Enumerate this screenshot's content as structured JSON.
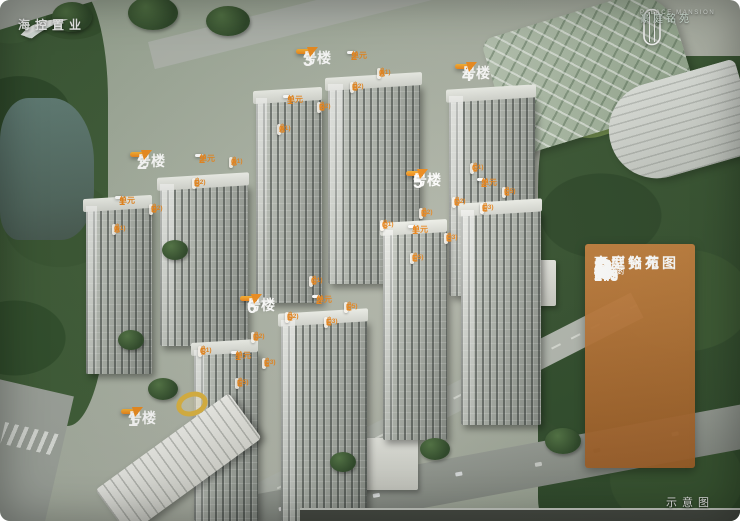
{
  "branding_left": {
    "name": "海控置业"
  },
  "branding_right": {
    "en": "PALACE MANSION",
    "cn": "豪庭铭苑"
  },
  "legend": {
    "title_line1": "豪庭铭苑",
    "title_line2": "户型分布图",
    "area_prefix": "建筑面积约",
    "unit": "m",
    "unit_sup": "2",
    "rows": [
      {
        "letter": "A",
        "value": "289"
      },
      {
        "letter": "B",
        "value": "245"
      },
      {
        "letter": "C",
        "value": "167"
      },
      {
        "letter": "D",
        "value": "163"
      },
      {
        "letter": "E",
        "value": "143"
      }
    ]
  },
  "caption": "示意图",
  "building_suffix": "号楼",
  "unit_suffix": "单元",
  "type_mid": "户型",
  "colors": {
    "label_orange": "#ef8c1d",
    "panel_brown": "#b06a2e",
    "label_text_orange": "#e8851c"
  },
  "building_labels": [
    {
      "num": "1",
      "x": 121,
      "y": 409
    },
    {
      "num": "2",
      "x": 130,
      "y": 152
    },
    {
      "num": "3",
      "x": 296,
      "y": 49
    },
    {
      "num": "4",
      "x": 455,
      "y": 64
    },
    {
      "num": "5",
      "x": 406,
      "y": 171
    },
    {
      "num": "6",
      "x": 240,
      "y": 296
    }
  ],
  "unit_labels": [
    {
      "num": "2",
      "x": 347,
      "y": 51
    },
    {
      "num": "1",
      "x": 283,
      "y": 95
    },
    {
      "num": "2",
      "x": 195,
      "y": 154
    },
    {
      "num": "1",
      "x": 115,
      "y": 196
    },
    {
      "num": "2",
      "x": 477,
      "y": 178
    },
    {
      "num": "1",
      "x": 408,
      "y": 225
    },
    {
      "num": "2",
      "x": 312,
      "y": 295
    },
    {
      "num": "1",
      "x": 231,
      "y": 351
    }
  ],
  "type_labels": [
    {
      "letter": "A",
      "num": "(01)",
      "x": 377,
      "y": 68
    },
    {
      "letter": "B",
      "num": "(02)",
      "x": 350,
      "y": 82
    },
    {
      "letter": "B",
      "num": "(02)",
      "x": 317,
      "y": 102
    },
    {
      "letter": "A",
      "num": "(01)",
      "x": 277,
      "y": 124
    },
    {
      "letter": "A",
      "num": "(01)",
      "x": 229,
      "y": 157
    },
    {
      "letter": "B",
      "num": "(02)",
      "x": 192,
      "y": 178
    },
    {
      "letter": "B",
      "num": "(02)",
      "x": 149,
      "y": 204
    },
    {
      "letter": "A",
      "num": "(01)",
      "x": 112,
      "y": 224
    },
    {
      "letter": "C",
      "num": "(01)",
      "x": 470,
      "y": 163
    },
    {
      "letter": "E",
      "num": "(05)",
      "x": 502,
      "y": 187
    },
    {
      "letter": "D",
      "num": "(02)",
      "x": 452,
      "y": 197
    },
    {
      "letter": "E",
      "num": "(03)",
      "x": 480,
      "y": 203
    },
    {
      "letter": "D",
      "num": "(02)",
      "x": 419,
      "y": 208
    },
    {
      "letter": "C",
      "num": "(01)",
      "x": 380,
      "y": 220
    },
    {
      "letter": "E",
      "num": "(03)",
      "x": 444,
      "y": 233
    },
    {
      "letter": "E",
      "num": "(05)",
      "x": 410,
      "y": 253
    },
    {
      "letter": "C",
      "num": "(01)",
      "x": 309,
      "y": 276
    },
    {
      "letter": "E",
      "num": "(05)",
      "x": 344,
      "y": 302
    },
    {
      "letter": "D",
      "num": "(02)",
      "x": 285,
      "y": 312
    },
    {
      "letter": "E",
      "num": "(03)",
      "x": 324,
      "y": 317
    },
    {
      "letter": "D",
      "num": "(02)",
      "x": 251,
      "y": 332
    },
    {
      "letter": "C",
      "num": "(01)",
      "x": 198,
      "y": 346
    },
    {
      "letter": "E",
      "num": "(03)",
      "x": 262,
      "y": 358
    },
    {
      "letter": "E",
      "num": "(05)",
      "x": 235,
      "y": 378
    }
  ]
}
